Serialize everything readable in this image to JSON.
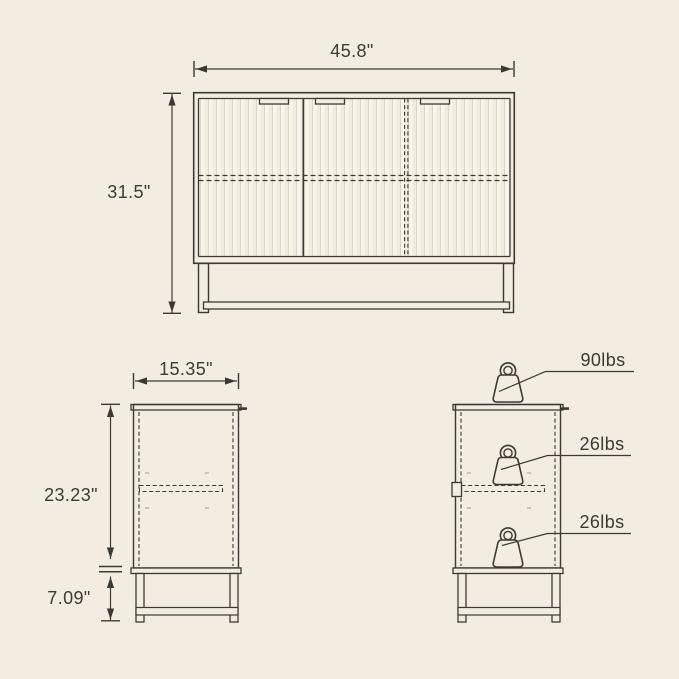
{
  "colors": {
    "background": "#f2ede0",
    "line": "#3a3933",
    "text": "#3b3a36",
    "flute_light": "#f8f5ea",
    "flute_dark": "#dcd6c5"
  },
  "front_view": {
    "width": "45.8\"",
    "height": "31.5\"",
    "door_count": 3
  },
  "side_view": {
    "depth": "15.35\"",
    "body_height": "23.23\"",
    "leg_height": "7.09\""
  },
  "load_capacity": {
    "top": "90lbs",
    "middle_shelf": "26lbs",
    "bottom_shelf": "26lbs",
    "icon": "weight-kettlebell-icon"
  }
}
